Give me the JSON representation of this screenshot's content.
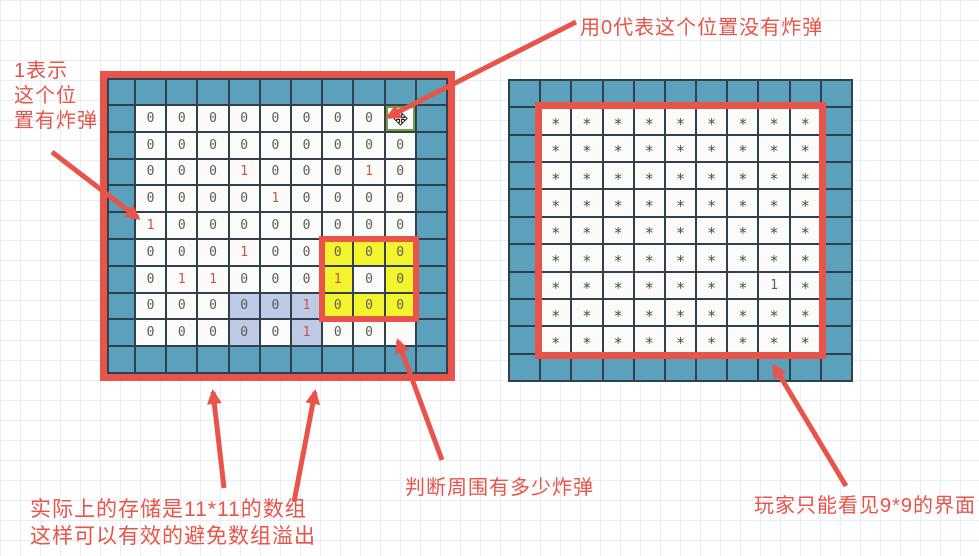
{
  "colors": {
    "red": "#e8544a",
    "teal": "#5ba1bb",
    "dark-line": "#31404e",
    "yellow": "#f4f42e",
    "lavender": "#bdc9e5",
    "cell-bg": "#fbfbf9",
    "zero-gray": "#5d5d55",
    "one-red": "#c2574e",
    "star-gray": "#4b4b4b",
    "cursor-green": "#74a13c",
    "paper-line": "#e9edf0"
  },
  "annotations": {
    "top_label": "用0代表这个位置没有炸弹",
    "left_label_lines": [
      "1表示",
      "这个位",
      "置有炸弹"
    ],
    "bottom_left_lines": [
      "实际上的存储是11*11的数组",
      "这样可以有效的避免数组溢出"
    ],
    "bottom_mid_label": "判断周围有多少炸弹",
    "bottom_right_label": "玩家只能看见9*9的界面"
  },
  "left_grid": {
    "label": "storage-array-11x11",
    "inner_rows": [
      [
        "0",
        "0",
        "0",
        "0",
        "0",
        "0",
        "0",
        "0",
        ""
      ],
      [
        "0",
        "0",
        "0",
        "0",
        "0",
        "0",
        "0",
        "0",
        "0"
      ],
      [
        "0",
        "0",
        "0",
        "1",
        "0",
        "0",
        "0",
        "1",
        "0"
      ],
      [
        "0",
        "0",
        "0",
        "0",
        "1",
        "0",
        "0",
        "0",
        "0"
      ],
      [
        "1",
        "0",
        "0",
        "0",
        "0",
        "0",
        "0",
        "0",
        "0"
      ],
      [
        "0",
        "0",
        "0",
        "1",
        "0",
        "0",
        "0",
        "0",
        "0"
      ],
      [
        "0",
        "1",
        "1",
        "0",
        "0",
        "0",
        "1",
        "0",
        "0"
      ],
      [
        "0",
        "0",
        "0",
        "0",
        "0",
        "1",
        "0",
        "0",
        "0"
      ],
      [
        "0",
        "0",
        "0",
        "0",
        "0",
        "1",
        "0",
        "0",
        ""
      ]
    ],
    "yellow_cells": [
      [
        6,
        7
      ],
      [
        6,
        8
      ],
      [
        6,
        9
      ],
      [
        7,
        7
      ],
      [
        7,
        9
      ],
      [
        8,
        7
      ],
      [
        8,
        8
      ],
      [
        8,
        9
      ]
    ],
    "lavender_cells": [
      [
        8,
        4
      ],
      [
        8,
        5
      ],
      [
        8,
        6
      ],
      [
        9,
        4
      ],
      [
        9,
        6
      ]
    ],
    "red_values": [
      [
        3,
        4
      ],
      [
        3,
        8
      ],
      [
        4,
        5
      ],
      [
        5,
        1
      ],
      [
        6,
        4
      ],
      [
        7,
        2
      ],
      [
        7,
        3
      ],
      [
        7,
        7
      ],
      [
        8,
        6
      ],
      [
        9,
        6
      ]
    ],
    "cursor_cell": [
      1,
      9
    ]
  },
  "right_grid": {
    "label": "player-view-9x9",
    "inner_rows": [
      [
        "*",
        "*",
        "*",
        "*",
        "*",
        "*",
        "*",
        "*",
        "*"
      ],
      [
        "*",
        "*",
        "*",
        "*",
        "*",
        "*",
        "*",
        "*",
        "*"
      ],
      [
        "*",
        "*",
        "*",
        "*",
        "*",
        "*",
        "*",
        "*",
        "*"
      ],
      [
        "*",
        "*",
        "*",
        "*",
        "*",
        "*",
        "*",
        "*",
        "*"
      ],
      [
        "*",
        "*",
        "*",
        "*",
        "*",
        "*",
        "*",
        "*",
        "*"
      ],
      [
        "*",
        "*",
        "*",
        "*",
        "*",
        "*",
        "*",
        "*",
        "*"
      ],
      [
        "*",
        "*",
        "*",
        "*",
        "*",
        "*",
        "*",
        "1",
        "*"
      ],
      [
        "*",
        "*",
        "*",
        "*",
        "*",
        "*",
        "*",
        "*",
        "*"
      ],
      [
        "*",
        "*",
        "*",
        "*",
        "*",
        "*",
        "*",
        "*",
        "*"
      ]
    ]
  }
}
